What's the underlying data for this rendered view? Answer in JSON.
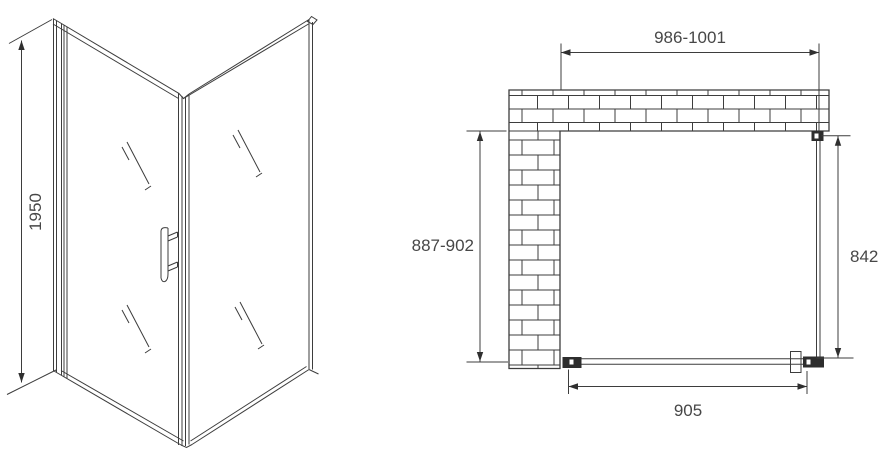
{
  "figure": {
    "title": "shower-enclosure-technical-drawing",
    "background": "#ffffff",
    "line_color": "#3d3d3d",
    "text_color": "#474747"
  },
  "perspective_view": {
    "description": "corner shower enclosure with hinged door and handle",
    "dimensions": {
      "height": {
        "label": "1950"
      }
    }
  },
  "plan_view": {
    "description": "top view with L-shaped brick wall, fixed side glass and door",
    "dimensions": {
      "opening_width": {
        "label": "986-1001"
      },
      "opening_depth": {
        "label": "887-902"
      },
      "side_panel": {
        "label": "842"
      },
      "door_width": {
        "label": "905"
      }
    }
  }
}
